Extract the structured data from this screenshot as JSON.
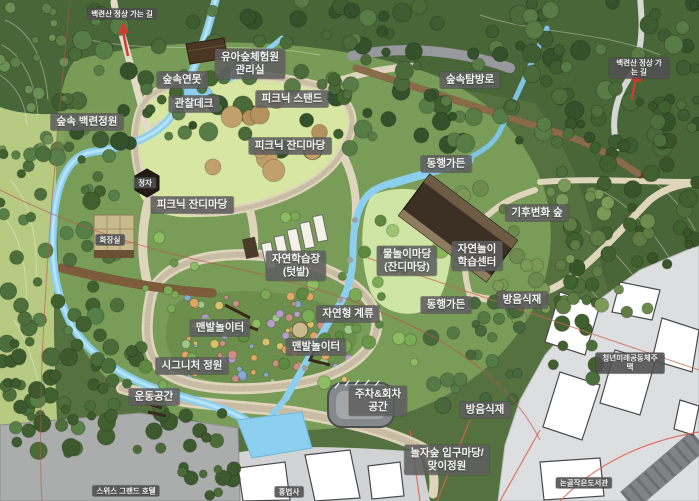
{
  "map": {
    "labels": [
      {
        "id": "summit-trail-west",
        "text": "백련산 정상 가는 길",
        "x": 122,
        "y": 14,
        "variant": "small"
      },
      {
        "id": "forest-experience-office",
        "text": "유아숲체험원\n관리실",
        "x": 250,
        "y": 64,
        "variant": "normal"
      },
      {
        "id": "forest-pond",
        "text": "숲속연못",
        "x": 182,
        "y": 80,
        "variant": "normal"
      },
      {
        "id": "observation-deck",
        "text": "관찰데크",
        "x": 194,
        "y": 104,
        "variant": "normal"
      },
      {
        "id": "picnic-stand",
        "text": "피크닉 스탠드",
        "x": 292,
        "y": 99,
        "variant": "normal"
      },
      {
        "id": "forest-baekryeon-garden",
        "text": "숲속 백련정원",
        "x": 87,
        "y": 122,
        "variant": "normal"
      },
      {
        "id": "forest-trail",
        "text": "숲속탐방로",
        "x": 470,
        "y": 80,
        "variant": "normal"
      },
      {
        "id": "summit-trail-east",
        "text": "백련산 정상 가는 길",
        "x": 639,
        "y": 68,
        "variant": "small"
      },
      {
        "id": "picnic-lawn-upper",
        "text": "피크닉 잔디마당",
        "x": 290,
        "y": 146,
        "variant": "normal"
      },
      {
        "id": "donghaeng-garden-upper",
        "text": "동행가든",
        "x": 446,
        "y": 164,
        "variant": "normal"
      },
      {
        "id": "pavilion",
        "text": "정자",
        "x": 145,
        "y": 183,
        "variant": "small"
      },
      {
        "id": "picnic-lawn-lower",
        "text": "피크닉 잔디마당",
        "x": 192,
        "y": 205,
        "variant": "normal"
      },
      {
        "id": "climate-change-forest",
        "text": "기후변화 숲",
        "x": 537,
        "y": 213,
        "variant": "normal"
      },
      {
        "id": "restroom",
        "text": "화장실",
        "x": 110,
        "y": 240,
        "variant": "small"
      },
      {
        "id": "nature-play-center",
        "text": "자연놀이\n학습센터",
        "x": 477,
        "y": 256,
        "variant": "normal"
      },
      {
        "id": "water-play-lawn",
        "text": "물놀이마당\n(잔디마당)",
        "x": 407,
        "y": 261,
        "variant": "normal"
      },
      {
        "id": "nature-learning-garden",
        "text": "자연학습장\n(텃밭)",
        "x": 296,
        "y": 266,
        "variant": "normal"
      },
      {
        "id": "soundproof-planting-upper",
        "text": "방음식재",
        "x": 522,
        "y": 300,
        "variant": "normal"
      },
      {
        "id": "donghaeng-garden-lower",
        "text": "동행가든",
        "x": 446,
        "y": 305,
        "variant": "normal"
      },
      {
        "id": "natural-stream",
        "text": "자연형 계류",
        "x": 348,
        "y": 314,
        "variant": "normal"
      },
      {
        "id": "barefoot-playground-west",
        "text": "맨발놀이터",
        "x": 220,
        "y": 328,
        "variant": "normal"
      },
      {
        "id": "barefoot-playground-east",
        "text": "맨발놀이터",
        "x": 316,
        "y": 347,
        "variant": "normal"
      },
      {
        "id": "youth-community-housing",
        "text": "청년미래공동체주택",
        "x": 630,
        "y": 363,
        "variant": "small"
      },
      {
        "id": "signature-garden",
        "text": "시그니처 정원",
        "x": 192,
        "y": 366,
        "variant": "normal"
      },
      {
        "id": "exercise-space",
        "text": "운동공간",
        "x": 154,
        "y": 397,
        "variant": "normal"
      },
      {
        "id": "parking-turnaround",
        "text": "주차&회차\n공간",
        "x": 378,
        "y": 401,
        "variant": "normal"
      },
      {
        "id": "soundproof-planting-lower",
        "text": "방음식재",
        "x": 485,
        "y": 410,
        "variant": "normal"
      },
      {
        "id": "noljasup-entrance-plaza",
        "text": "놀자숲 입구마당/\n맞이정원",
        "x": 447,
        "y": 460,
        "variant": "normal"
      },
      {
        "id": "nongol-small-library",
        "text": "논골작은도서관",
        "x": 584,
        "y": 483,
        "variant": "small"
      },
      {
        "id": "swiss-grand-hotel",
        "text": "스위스 그랜드 호텔",
        "x": 126,
        "y": 491,
        "variant": "small"
      },
      {
        "id": "hongbeopsa-temple",
        "text": "홍법사",
        "x": 289,
        "y": 492,
        "variant": "small"
      }
    ],
    "arrows": [
      {
        "id": "summit-arrow-west",
        "direction": "up"
      },
      {
        "id": "summit-arrow-east",
        "direction": "up"
      }
    ],
    "colors": {
      "forest_green": "#486637",
      "park_green": "#7da05a",
      "lawn_green": "#d7e7a2",
      "water_blue": "#8ccfee",
      "path_beige": "#dfd5bc",
      "boardwalk_brown": "#5c4028",
      "building_brown": "#3c2f24",
      "urban_gray": "#dcdee0",
      "hotel_gray": "#aaadab",
      "label_bg": "#5f5f5f",
      "label_text": "#f4f4f4",
      "arrow_red": "#d23b2f",
      "boundary_red": "#c0504a"
    }
  }
}
